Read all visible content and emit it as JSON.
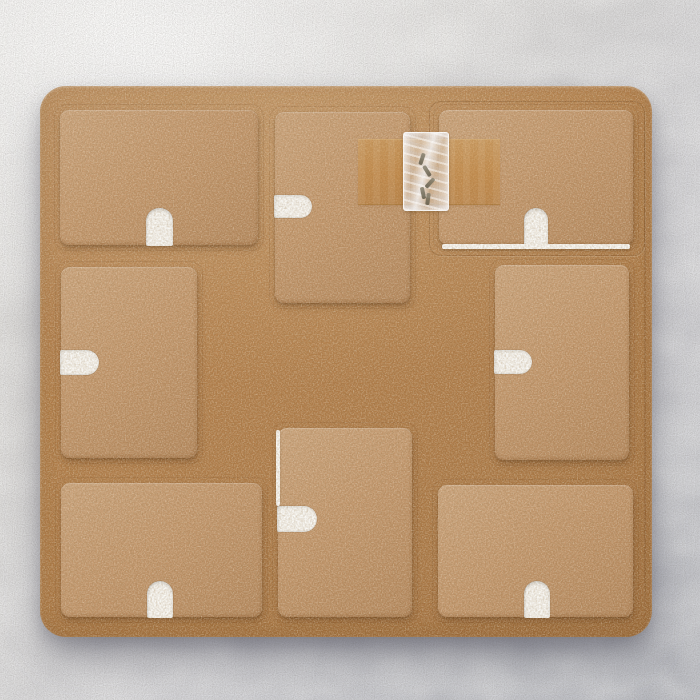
{
  "scene": {
    "title": "Flat-lay photo: brown MDF craft board holding eight rectangular hardboard panels, each with a white keyhole hanging slot, plus a taped clear bag of screws",
    "wall": {
      "highlight_color": "#ecebe8",
      "base_color": "#d6d6d8",
      "shadow_color": "#c9cace"
    },
    "board": {
      "material": "MDF hardboard",
      "color": "#b5804b",
      "x": 40,
      "y": 86,
      "width": 612,
      "height": 551,
      "corner_radius": 26
    },
    "panel_color": "#c29468",
    "notch_color": "#fcfcfa",
    "panel_count": 8,
    "panels": [
      {
        "id": "top-left",
        "x": 60,
        "y": 110,
        "w": 198,
        "h": 135,
        "notch": {
          "side": "bottom",
          "offset": 86,
          "w": 27,
          "h": 38
        }
      },
      {
        "id": "top-middle",
        "x": 275,
        "y": 112,
        "w": 135,
        "h": 191,
        "notch": {
          "side": "left",
          "offset": 83,
          "w": 38,
          "h": 23
        }
      },
      {
        "id": "top-right",
        "x": 439,
        "y": 110,
        "w": 194,
        "h": 135,
        "notch": {
          "side": "bottom",
          "offset": 85,
          "w": 24,
          "h": 38
        },
        "white_bottom_edge": true
      },
      {
        "id": "middle-left",
        "x": 61,
        "y": 267,
        "w": 136,
        "h": 191,
        "notch": {
          "side": "left",
          "offset": 83,
          "w": 39,
          "h": 25
        }
      },
      {
        "id": "middle-right",
        "x": 495,
        "y": 265,
        "w": 134,
        "h": 195,
        "notch": {
          "side": "left",
          "offset": 85,
          "w": 38,
          "h": 24
        }
      },
      {
        "id": "bottom-left",
        "x": 61,
        "y": 483,
        "w": 201,
        "h": 134,
        "notch": {
          "side": "bottom",
          "offset": 86,
          "w": 26,
          "h": 37
        }
      },
      {
        "id": "bottom-middle",
        "x": 278,
        "y": 428,
        "w": 134,
        "h": 189,
        "notch": {
          "side": "left",
          "offset": 78,
          "w": 40,
          "h": 26
        },
        "white_left_edge": true
      },
      {
        "id": "bottom-right",
        "x": 438,
        "y": 485,
        "w": 195,
        "h": 132,
        "notch": {
          "side": "bottom",
          "offset": 86,
          "w": 26,
          "h": 37
        }
      }
    ],
    "cut_outline_top_right": {
      "x": 429,
      "y": 101,
      "w": 214,
      "h": 153
    },
    "score_line_right": {
      "x": 644,
      "y": 102,
      "h": 524
    },
    "tape": {
      "color": "#c68a3c",
      "x": 358,
      "y": 139,
      "width": 142,
      "height": 64
    },
    "screw_bag": {
      "x": 403,
      "y": 132,
      "width": 44,
      "height": 77,
      "tint": "#eceef2",
      "screw_color": "#5f5947",
      "screws": [
        {
          "left": 16,
          "top": 20,
          "angle": 18
        },
        {
          "left": 21,
          "top": 32,
          "angle": -32
        },
        {
          "left": 24,
          "top": 44,
          "angle": 42
        },
        {
          "left": 17,
          "top": 54,
          "angle": -12
        },
        {
          "left": 22,
          "top": 60,
          "angle": 8
        }
      ]
    }
  }
}
